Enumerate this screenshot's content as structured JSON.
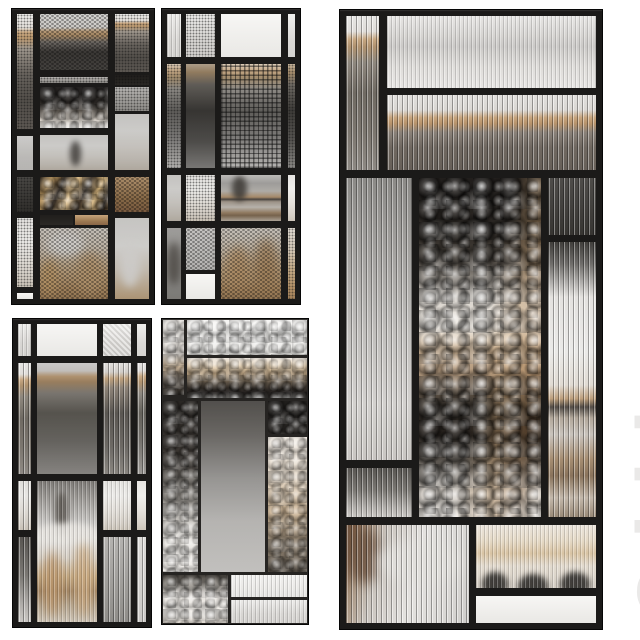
{
  "meta": {
    "description": "3D render of five black-framed decorative glass partitions over a blurred cafe interior",
    "background": "#ffffff"
  },
  "watermark": {
    "text": "3ddd",
    "color": "#e9e8e7"
  },
  "palette": {
    "frame_black": "#1b1a19",
    "thin_frame": "#262422",
    "tan_wood_band": "#c9a87f",
    "bronze_glass": "#d9b87f",
    "dark_glass": "#232120",
    "silver_glass": "#e8e4df",
    "white_background": "#ffffff"
  },
  "panels": [
    {
      "name": "glass-partition-top-left",
      "x": 11,
      "y": 8,
      "w": 144,
      "h": 297,
      "frame": 6,
      "thin": false,
      "panes": [
        {
          "x": 0,
          "y": 0,
          "w": 16,
          "h": 115,
          "tex": "mesh",
          "bg": "meshfade"
        },
        {
          "x": 0,
          "y": 122,
          "w": 16,
          "h": 34,
          "tex": "mesh-fine",
          "bg": "frost"
        },
        {
          "x": 0,
          "y": 163,
          "w": 16,
          "h": 35,
          "tex": "mesh",
          "bg": "dark"
        },
        {
          "x": 0,
          "y": 204,
          "w": 16,
          "h": 69,
          "tex": "mesh",
          "bg": "cafe-light"
        },
        {
          "x": 0,
          "y": 279,
          "w": 16,
          "h": 6,
          "tex": "none",
          "bg": "frost-bright"
        },
        {
          "x": 23,
          "y": 0,
          "w": 68,
          "h": 56,
          "tex": "hex",
          "bg": "wallmesh"
        },
        {
          "x": 23,
          "y": 63,
          "w": 68,
          "h": 6,
          "tex": "mesh",
          "bg": "gray"
        },
        {
          "x": 23,
          "y": 73,
          "w": 68,
          "h": 41,
          "tex": "hammer",
          "bg": "hammer-dark"
        },
        {
          "x": 23,
          "y": 121,
          "w": 68,
          "h": 35,
          "tex": "mesh-fine",
          "bg": "cafe-light",
          "blobs": [
            [
              44,
              18,
              16,
              70,
              "#3f3b37",
              3,
              0.8
            ]
          ]
        },
        {
          "x": 23,
          "y": 163,
          "w": 68,
          "h": 33,
          "tex": "hammer",
          "bg": "bronze"
        },
        {
          "x": 23,
          "y": 201,
          "w": 33,
          "h": 10,
          "tex": "none",
          "bg": "black"
        },
        {
          "x": 58,
          "y": 201,
          "w": 33,
          "h": 10,
          "tex": "none",
          "bg": "wood"
        },
        {
          "x": 23,
          "y": 214,
          "w": 68,
          "h": 71,
          "tex": "hex",
          "bg": "cafe-warm",
          "blobs": [
            [
              10,
              5,
              55,
              35,
              "#efece8",
              4,
              0.9
            ],
            [
              2,
              45,
              25,
              50,
              "#caa36e",
              4,
              0.8
            ],
            [
              55,
              35,
              38,
              60,
              "#c7a478",
              5,
              0.85
            ]
          ]
        },
        {
          "x": 98,
          "y": 0,
          "w": 34,
          "h": 58,
          "tex": "mesh",
          "bg": "meshfade"
        },
        {
          "x": 98,
          "y": 61,
          "w": 34,
          "h": 10,
          "tex": "mesh",
          "bg": "black"
        },
        {
          "x": 98,
          "y": 73,
          "w": 34,
          "h": 24,
          "tex": "mesh",
          "bg": "gray"
        },
        {
          "x": 98,
          "y": 100,
          "w": 34,
          "h": 56,
          "tex": "mesh-fine",
          "bg": "cafe-light"
        },
        {
          "x": 98,
          "y": 163,
          "w": 34,
          "h": 35,
          "tex": "hex",
          "bg": "wood"
        },
        {
          "x": 98,
          "y": 204,
          "w": 34,
          "h": 81,
          "tex": "mesh-fine",
          "bg": "cafe-chair",
          "blobs": [
            [
              15,
              30,
              60,
              55,
              "#f1efec",
              4,
              0.9
            ]
          ]
        }
      ]
    },
    {
      "name": "glass-partition-top-middle",
      "x": 161,
      "y": 8,
      "w": 140,
      "h": 297,
      "frame": 6,
      "thin": false,
      "panes": [
        {
          "x": 0,
          "y": 0,
          "w": 14,
          "h": 43,
          "tex": "reeded-soft",
          "bg": "frost"
        },
        {
          "x": 0,
          "y": 50,
          "w": 14,
          "h": 104,
          "tex": "mesh",
          "bg": "wallb"
        },
        {
          "x": 0,
          "y": 161,
          "w": 14,
          "h": 46,
          "tex": "mesh-fine",
          "bg": "cafe-light"
        },
        {
          "x": 0,
          "y": 214,
          "w": 14,
          "h": 71,
          "tex": "mesh-fine",
          "bg": "gray",
          "blobs": [
            [
              0,
              20,
              100,
              60,
              "#4a453f",
              4,
              0.7
            ]
          ]
        },
        {
          "x": 19,
          "y": 0,
          "w": 29,
          "h": 43,
          "tex": "mesh",
          "bg": "frost"
        },
        {
          "x": 19,
          "y": 50,
          "w": 29,
          "h": 104,
          "tex": "mesh-fine",
          "bg": "wallb-dark"
        },
        {
          "x": 19,
          "y": 161,
          "w": 29,
          "h": 46,
          "tex": "mesh",
          "bg": "cafe-light"
        },
        {
          "x": 19,
          "y": 214,
          "w": 29,
          "h": 42,
          "tex": "hex",
          "bg": "frost-dim"
        },
        {
          "x": 19,
          "y": 260,
          "w": 29,
          "h": 25,
          "tex": "none",
          "bg": "frost-bright"
        },
        {
          "x": 54,
          "y": 0,
          "w": 60,
          "h": 43,
          "tex": "none",
          "bg": "frost-bright"
        },
        {
          "x": 54,
          "y": 50,
          "w": 60,
          "h": 104,
          "tex": "waffle",
          "bg": "wallb"
        },
        {
          "x": 54,
          "y": 161,
          "w": 60,
          "h": 46,
          "tex": "mesh-fine",
          "bg": "cafe-table",
          "blobs": [
            [
              18,
              2,
              26,
              55,
              "#44403b",
              3,
              0.85
            ]
          ]
        },
        {
          "x": 54,
          "y": 214,
          "w": 60,
          "h": 71,
          "tex": "hex",
          "bg": "cafe-warm",
          "blobs": [
            [
              8,
              25,
              40,
              60,
              "#c29b6d",
              5,
              0.8
            ],
            [
              55,
              15,
              40,
              70,
              "#b08a5e",
              5,
              0.75
            ]
          ]
        },
        {
          "x": 121,
          "y": 0,
          "w": 7,
          "h": 43,
          "tex": "none",
          "bg": "frost"
        },
        {
          "x": 121,
          "y": 50,
          "w": 7,
          "h": 104,
          "tex": "mesh",
          "bg": "wallb-dark"
        },
        {
          "x": 121,
          "y": 161,
          "w": 7,
          "h": 46,
          "tex": "none",
          "bg": "cafe-light"
        },
        {
          "x": 121,
          "y": 214,
          "w": 7,
          "h": 71,
          "tex": "mesh",
          "bg": "cafe-warm"
        }
      ]
    },
    {
      "name": "glass-partition-bottom-left",
      "x": 12,
      "y": 318,
      "w": 140,
      "h": 310,
      "frame": 6,
      "thin": false,
      "panes": [
        {
          "x": 0,
          "y": 0,
          "w": 13,
          "h": 32,
          "tex": "reeded-soft",
          "bg": "frost"
        },
        {
          "x": 0,
          "y": 39,
          "w": 13,
          "h": 111,
          "tex": "reeded",
          "bg": "wall"
        },
        {
          "x": 0,
          "y": 157,
          "w": 13,
          "h": 49,
          "tex": "reeded",
          "bg": "cafe-light"
        },
        {
          "x": 0,
          "y": 213,
          "w": 13,
          "h": 85,
          "tex": "reeded",
          "bg": "graydark"
        },
        {
          "x": 19,
          "y": 0,
          "w": 60,
          "h": 32,
          "tex": "none",
          "bg": "frost-bright"
        },
        {
          "x": 19,
          "y": 39,
          "w": 60,
          "h": 111,
          "tex": "mesh-fine",
          "bg": "graywall"
        },
        {
          "x": 19,
          "y": 157,
          "w": 60,
          "h": 141,
          "tex": "reeded-soft",
          "bg": "cafe-full",
          "blobs": [
            [
              30,
              8,
              22,
              30,
              "#504b45",
              3,
              0.8
            ],
            [
              0,
              30,
              100,
              14,
              "#e9e6e1",
              3,
              0.9
            ],
            [
              8,
              50,
              35,
              45,
              "#bb9468",
              5,
              0.8
            ],
            [
              60,
              45,
              35,
              50,
              "#caa77c",
              5,
              0.8
            ]
          ]
        },
        {
          "x": 85,
          "y": 0,
          "w": 28,
          "h": 32,
          "tex": "diag",
          "bg": "frost"
        },
        {
          "x": 85,
          "y": 39,
          "w": 28,
          "h": 111,
          "tex": "reeded",
          "bg": "graywall-dk"
        },
        {
          "x": 85,
          "y": 157,
          "w": 28,
          "h": 49,
          "tex": "reeded-soft",
          "bg": "cafe-light"
        },
        {
          "x": 85,
          "y": 213,
          "w": 28,
          "h": 85,
          "tex": "reeded",
          "bg": "gray"
        },
        {
          "x": 119,
          "y": 0,
          "w": 9,
          "h": 32,
          "tex": "none",
          "bg": "frost"
        },
        {
          "x": 119,
          "y": 39,
          "w": 9,
          "h": 111,
          "tex": "reeded",
          "bg": "graywall"
        },
        {
          "x": 119,
          "y": 157,
          "w": 9,
          "h": 49,
          "tex": "none",
          "bg": "cafe-light"
        },
        {
          "x": 119,
          "y": 213,
          "w": 9,
          "h": 85,
          "tex": "reeded",
          "bg": "frost-dim"
        }
      ]
    },
    {
      "name": "glass-partition-bottom-middle",
      "x": 161,
      "y": 318,
      "w": 148,
      "h": 307,
      "frame": 2,
      "thin": true,
      "panes": [
        {
          "x": 0,
          "y": 0,
          "w": 21,
          "h": 75,
          "tex": "hammer",
          "bg": "hamleft"
        },
        {
          "x": 24,
          "y": 0,
          "w": 120,
          "h": 35,
          "tex": "hammer",
          "bg": "frost-bright"
        },
        {
          "x": 24,
          "y": 38,
          "w": 120,
          "h": 40,
          "tex": "hammer",
          "bg": "bronzeband"
        },
        {
          "x": 0,
          "y": 81,
          "w": 35,
          "h": 171,
          "tex": "hammer",
          "bg": "hamdklt"
        },
        {
          "x": 38,
          "y": 81,
          "w": 64,
          "h": 171,
          "tex": "mesh-fine",
          "bg": "grayscene"
        },
        {
          "x": 105,
          "y": 81,
          "w": 39,
          "h": 33,
          "tex": "hammer",
          "bg": "black"
        },
        {
          "x": 105,
          "y": 117,
          "w": 39,
          "h": 135,
          "tex": "hammer",
          "bg": "hamwarm"
        },
        {
          "x": 0,
          "y": 255,
          "w": 65,
          "h": 48,
          "tex": "hammer",
          "bg": "hamsilver"
        },
        {
          "x": 68,
          "y": 255,
          "w": 76,
          "h": 22,
          "tex": "reeded-soft",
          "bg": "frost-bright"
        },
        {
          "x": 68,
          "y": 280,
          "w": 76,
          "h": 23,
          "tex": "reeded-soft",
          "bg": "frost"
        }
      ]
    },
    {
      "name": "glass-partition-large-right",
      "x": 339,
      "y": 9,
      "w": 264,
      "h": 621,
      "frame": 7,
      "thin": false,
      "panes": [
        {
          "x": 0,
          "y": 0,
          "w": 33,
          "h": 154,
          "tex": "reeded",
          "bg": "wall"
        },
        {
          "x": 41,
          "y": 0,
          "w": 209,
          "h": 72,
          "tex": "reeded-soft",
          "bg": "frost-band"
        },
        {
          "x": 41,
          "y": 79,
          "w": 209,
          "h": 75,
          "tex": "reeded",
          "bg": "wall2"
        },
        {
          "x": 0,
          "y": 162,
          "w": 66,
          "h": 282,
          "tex": "reeded",
          "bg": "grayscene-lt"
        },
        {
          "x": 0,
          "y": 452,
          "w": 66,
          "h": 49,
          "tex": "reeded",
          "bg": "graydark"
        },
        {
          "x": 73,
          "y": 162,
          "w": 122,
          "h": 339,
          "tex": "hammer-strong",
          "bg": "hammix"
        },
        {
          "x": 202,
          "y": 162,
          "w": 48,
          "h": 57,
          "tex": "reeded",
          "bg": "dark"
        },
        {
          "x": 202,
          "y": 226,
          "w": 48,
          "h": 275,
          "tex": "reeded",
          "bg": "cafe-table2"
        },
        {
          "x": 0,
          "y": 509,
          "w": 123,
          "h": 98,
          "tex": "reeded",
          "bg": "floor",
          "blobs": [
            [
              0,
              0,
              28,
              60,
              "#6b4f3a",
              6,
              0.85
            ],
            [
              25,
              15,
              70,
              45,
              "#e9e7e3",
              6,
              0.9
            ]
          ]
        },
        {
          "x": 130,
          "y": 509,
          "w": 120,
          "h": 63,
          "tex": "reeded-soft",
          "bg": "cups",
          "blobs": [
            [
              5,
              75,
              22,
              40,
              "#2c2a27",
              3,
              0.9
            ],
            [
              35,
              78,
              25,
              40,
              "#2c2a27",
              3,
              0.9
            ],
            [
              70,
              75,
              25,
              40,
              "#2c2a27",
              3,
              0.9
            ]
          ]
        },
        {
          "x": 130,
          "y": 580,
          "w": 120,
          "h": 27,
          "tex": "none",
          "bg": "frost-bright"
        }
      ]
    }
  ]
}
